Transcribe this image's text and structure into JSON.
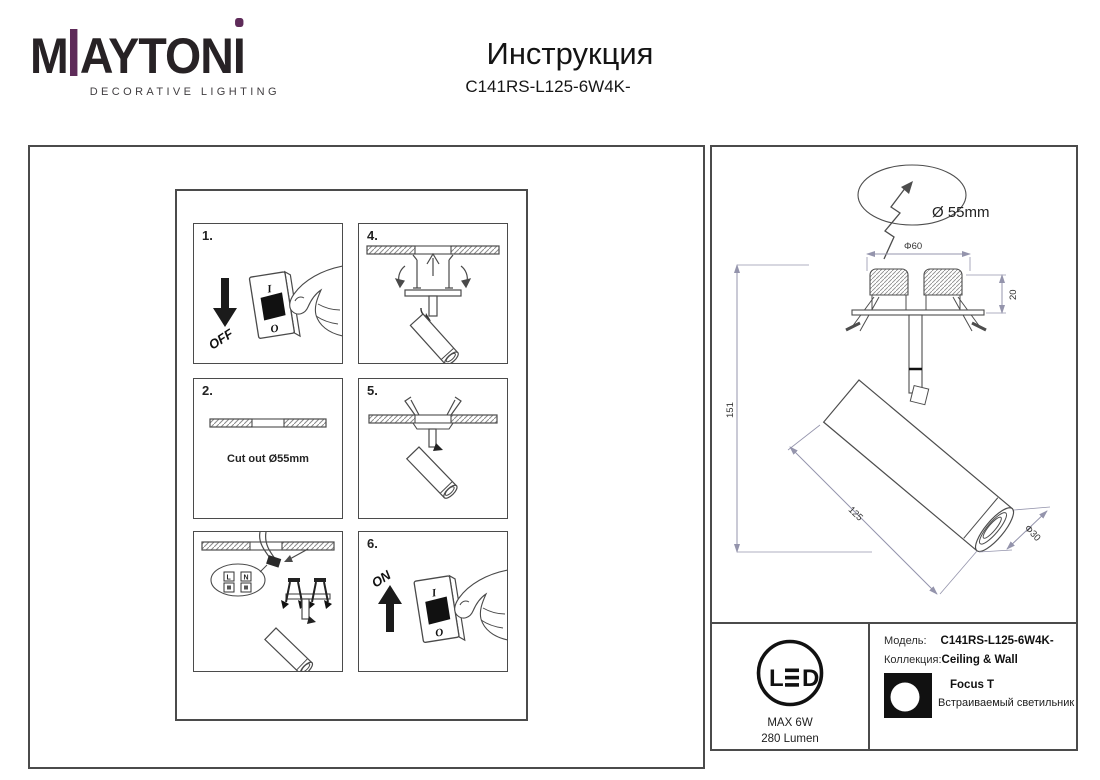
{
  "page": {
    "title": "Инструкция",
    "model": "C141RS-L125-6W4K-"
  },
  "brand": {
    "m": "M",
    "rest": "AYTON",
    "i": "I",
    "sub": "DECORATIVE LIGHTING"
  },
  "colors": {
    "purple": "#5e2b59",
    "line": "#4d4d4d",
    "dim": "#9494ac"
  },
  "steps": {
    "one": {
      "num": "1.",
      "arrow_label": "OFF",
      "switch_on": "I",
      "switch_off": "O"
    },
    "two": {
      "num": "2.",
      "caption": "Cut out Ø55mm"
    },
    "three": {
      "terminal_l": "L",
      "terminal_n": "N"
    },
    "four": {
      "num": "4."
    },
    "five": {
      "num": "5."
    },
    "six": {
      "num": "6.",
      "arrow_label": "ON",
      "switch_on": "I",
      "switch_off": "O"
    }
  },
  "drawing": {
    "cutout_dia": "Ø 55mm",
    "mount_dia": "Φ60",
    "recess_depth": "20",
    "total_height": "151",
    "body_length": "125",
    "body_dia": "Φ30"
  },
  "spec": {
    "led_l": "L",
    "led_d": "D",
    "max_power": "MAX 6W",
    "luminous_flux": "280 Lumen",
    "model_label": "Модель:",
    "model_value": "C141RS-L125-6W4K-",
    "collection_label": "Коллекция:",
    "collection_value": "Ceiling & Wall",
    "series_name": "Focus T",
    "product_type": "Встраиваемый светильник"
  }
}
